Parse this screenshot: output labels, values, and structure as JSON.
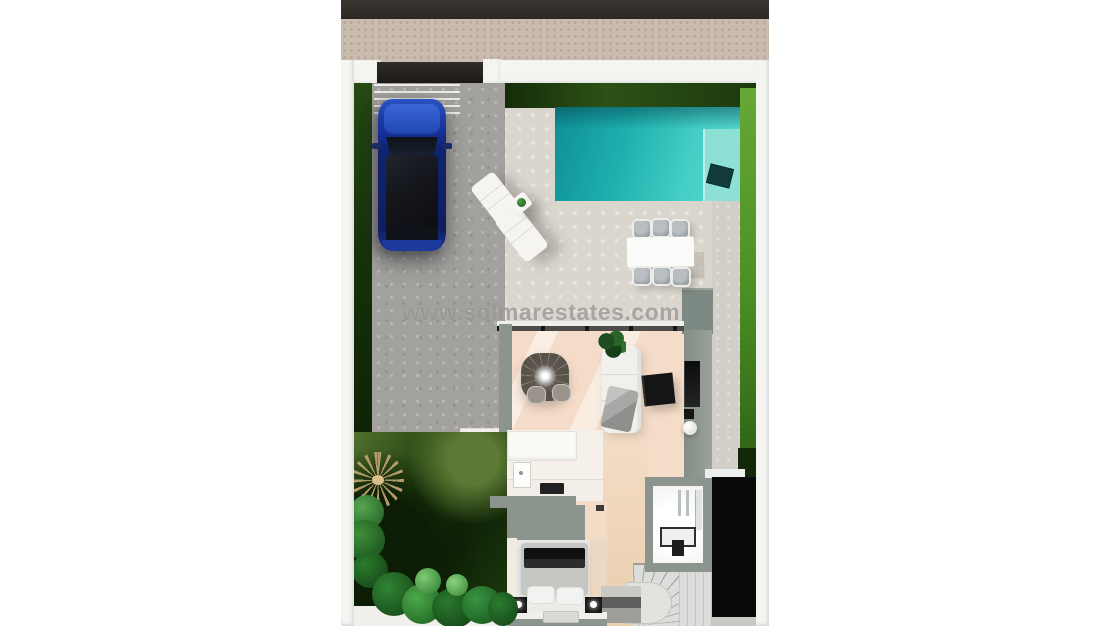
{
  "watermark": {
    "text": "www.solmarestates.com"
  },
  "colors": {
    "asphalt": "#322e2a",
    "sidewalk": "#c9bcae",
    "wall_white": "#f4f4f1",
    "gate_dark": "#262220",
    "grass_bright": "#4c8f24",
    "driveway_gray": "#a3a19d",
    "patio_light": "#dad5cd",
    "patio_cream": "#e9e4d9",
    "pool_cyan": "#45cfc7",
    "pool_steps": "#8ce0d5",
    "car_blue": "#1d3ca6",
    "house_wall_gray": "#8b948d",
    "floor_peach": "#f4dcc8",
    "void_black": "#0a0a0a",
    "watermark_gray": "#878787"
  }
}
